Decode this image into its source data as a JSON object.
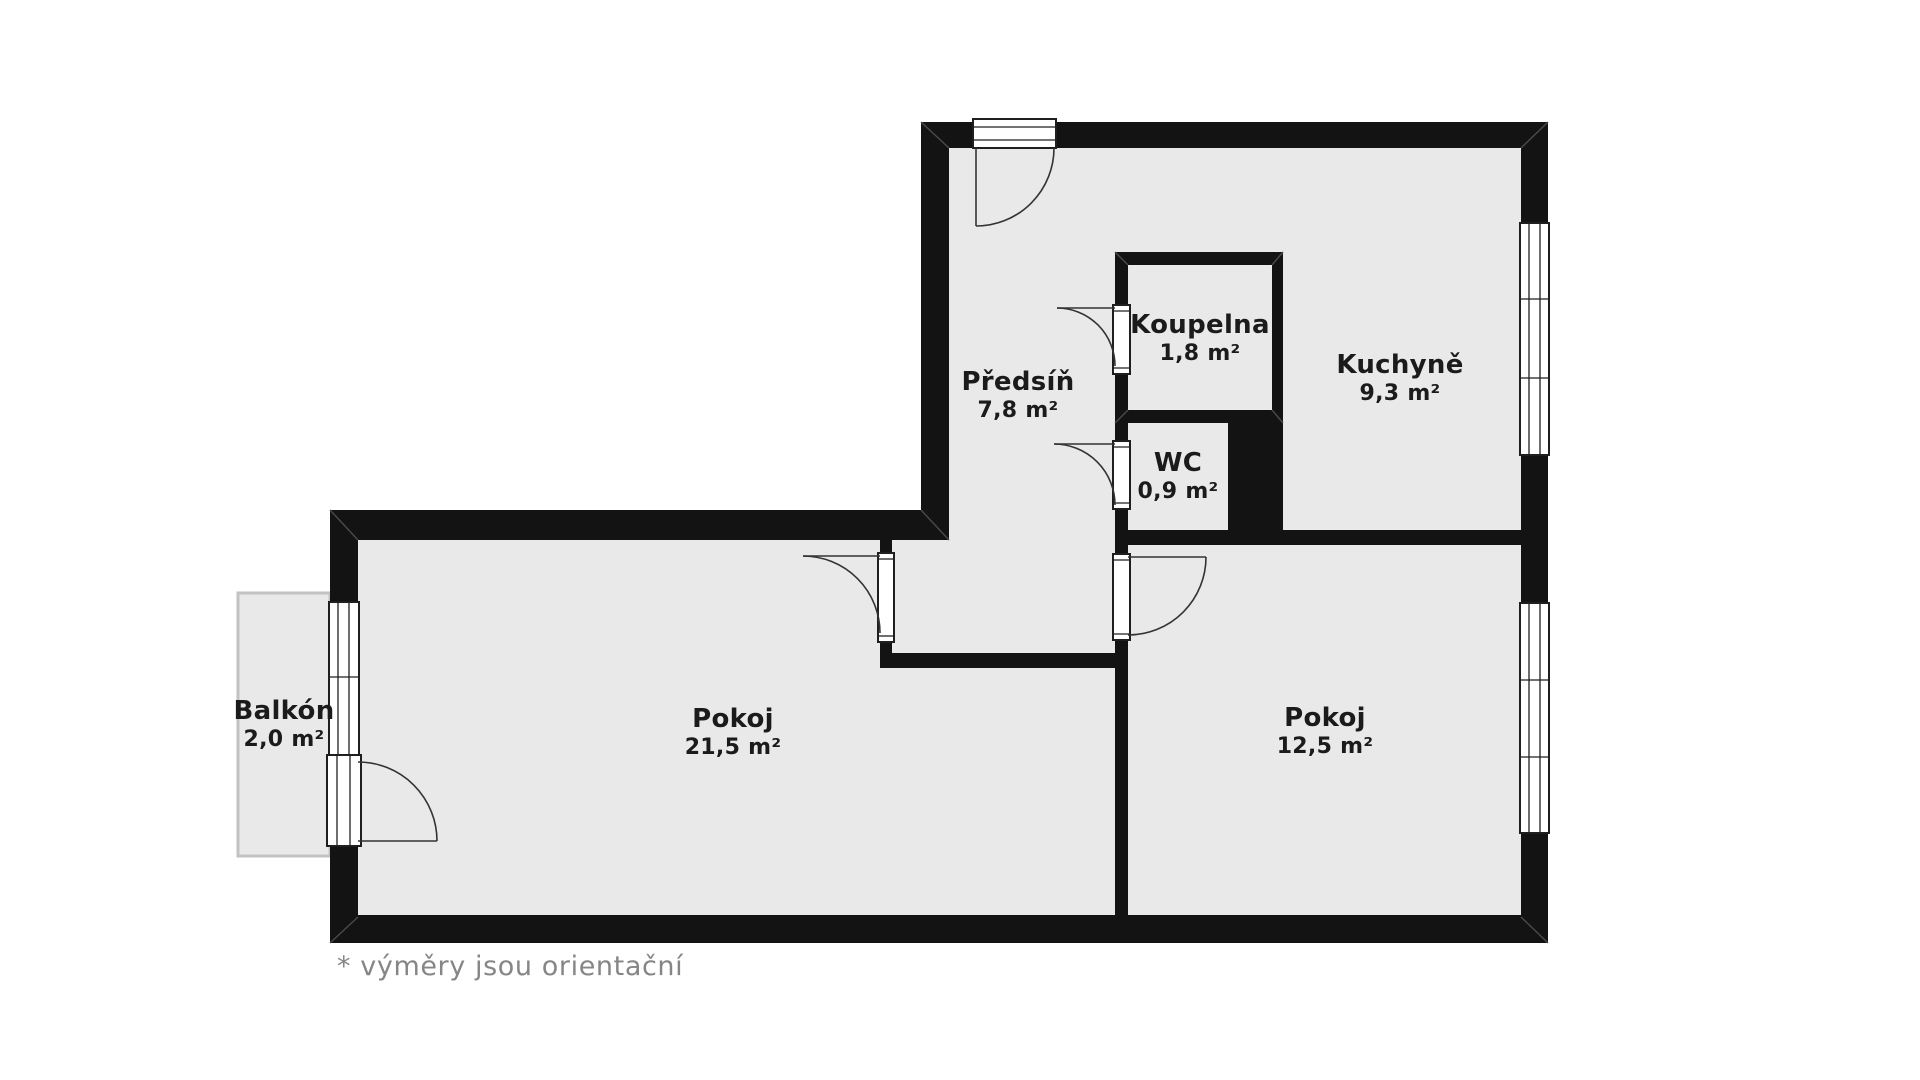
{
  "floorplan": {
    "rooms": [
      {
        "name": "Předsíň",
        "area": "7,8 m²"
      },
      {
        "name": "Koupelna",
        "area": "1,8 m²"
      },
      {
        "name": "WC",
        "area": "0,9 m²"
      },
      {
        "name": "Kuchyně",
        "area": "9,3 m²"
      },
      {
        "name": "Pokoj",
        "area": "21,5 m²"
      },
      {
        "name": "Pokoj",
        "area": "12,5 m²"
      },
      {
        "name": "Balkón",
        "area": "2,0 m²"
      }
    ],
    "footnote": "* výměry jsou orientační",
    "colors": {
      "background": "#ffffff",
      "floor": "#e9e9e9",
      "wall": "#131313",
      "label_text": "#1b1b1b",
      "footnote_text": "#868686",
      "balcony_border": "#c2c2c2"
    }
  }
}
